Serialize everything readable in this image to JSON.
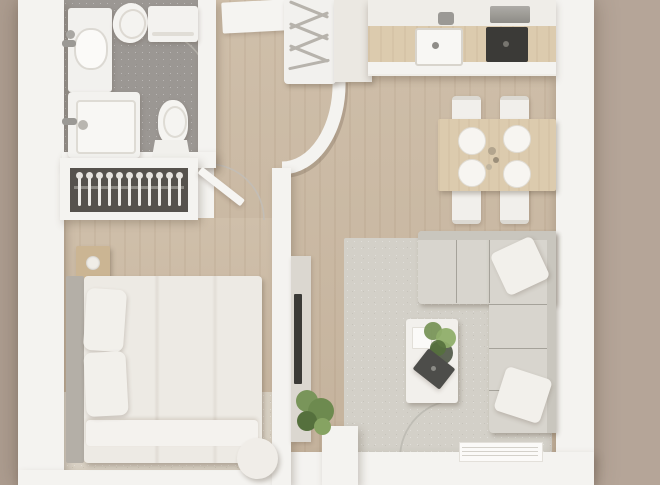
{
  "scene": {
    "description": "Top-down 3D rendered floor plan of a one-bedroom apartment",
    "rooms": [
      {
        "name": "bathroom",
        "items": [
          "vanity-sink",
          "bidet",
          "washing-machine",
          "shower-tray",
          "toilet"
        ]
      },
      {
        "name": "hallway",
        "items": [
          "entrance-door",
          "entry-wardrobe-with-hangers",
          "curved-wall"
        ]
      },
      {
        "name": "kitchen",
        "items": [
          "tall-cabinet",
          "counter-wood-top",
          "sink",
          "cooktop",
          "extractor"
        ]
      },
      {
        "name": "dining-area",
        "items": [
          "wood-dining-table",
          "chair x4",
          "plate x4",
          "table-decor"
        ]
      },
      {
        "name": "living-room",
        "items": [
          "corner-sofa",
          "sofa-cushion x2",
          "coffee-table",
          "potted-plant",
          "dark-tray",
          "book",
          "tv-console",
          "tv",
          "area-rug",
          "floor-plant",
          "balcony-door",
          "window"
        ]
      },
      {
        "name": "bedroom",
        "items": [
          "hanger-closet",
          "double-bed",
          "pillow x2",
          "headboard",
          "nightstand x2",
          "area-rug",
          "round-pouf"
        ]
      }
    ]
  },
  "palette": {
    "bg_left": "#ad9d90",
    "bg_main": "#b2a295",
    "bg_right": "#b5a598",
    "wall": "#f4f3f0",
    "wood": "#c9b8a2",
    "wood_dark": "#c2b099",
    "bath_floor": "#9b9793",
    "closet_dark": "#56524d",
    "linen": "#edeae4",
    "pillow": "#f2f0eb",
    "headboard": "#b4afa7",
    "wood_furn": "#cbb593",
    "sofa": "#d8d5ce",
    "sofa_edge": "#c9c6be",
    "rug_living": "#d3d0c8",
    "rug_bed": "#d9d1c4",
    "table_wood": "#dccbae",
    "appliance": "#3b3a37",
    "steel": "#9b9995",
    "green": "#79955a",
    "green_dark": "#55703d",
    "tray": "#4d4d4a",
    "arc": "#c2beb7"
  }
}
